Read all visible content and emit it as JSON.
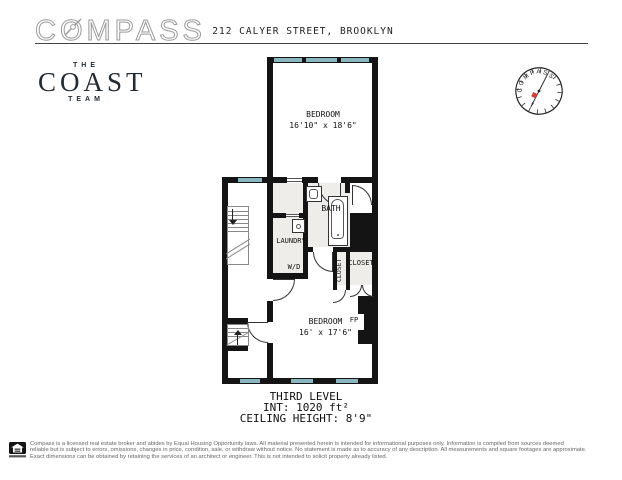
{
  "header": {
    "brand": "COMPASS",
    "address": "212 CALYER STREET, BROOKLYN"
  },
  "team_logo": {
    "top": "THE",
    "name": "COAST",
    "bottom": "TEAM"
  },
  "compass_rose": {
    "label": "COMPASS"
  },
  "floorplan": {
    "bedroom1": {
      "name": "BEDROOM",
      "dims": "16'10\" x 18'6\""
    },
    "bedroom2": {
      "name": "BEDROOM",
      "dims": "16' x 17'6\""
    },
    "bath_label": "BATH",
    "laundry_label": "LAUNDRY",
    "wd_label": "W/D",
    "closet_small_label": "CLOSET",
    "closet_large_label": "CLOSET",
    "fireplace_label": "FP"
  },
  "level_info": {
    "line1": "THIRD LEVEL",
    "line2": "INT: 1020 ft²",
    "line3": "CEILING HEIGHT: 8'9\""
  },
  "footer": {
    "line1": "Compass is a licensed real estate broker and abides by Equal Housing Opportunity laws. All material presented herein is intended for informational purposes only. Information is compiled from sources deemed",
    "line2": "reliable but is subject to errors, omissions, changes in price, condition, sale, or withdraw without notice. No statement is made as to accuracy of any description. All measurements and square footages are approximate.",
    "line3": "Exact dimensions can be obtained by retaining the services of an architect or engineer. This is not intended to solicit property already listed."
  },
  "colors": {
    "wall": "#141414",
    "window": "#8ab7bf",
    "needle_red": "#d2413a"
  }
}
